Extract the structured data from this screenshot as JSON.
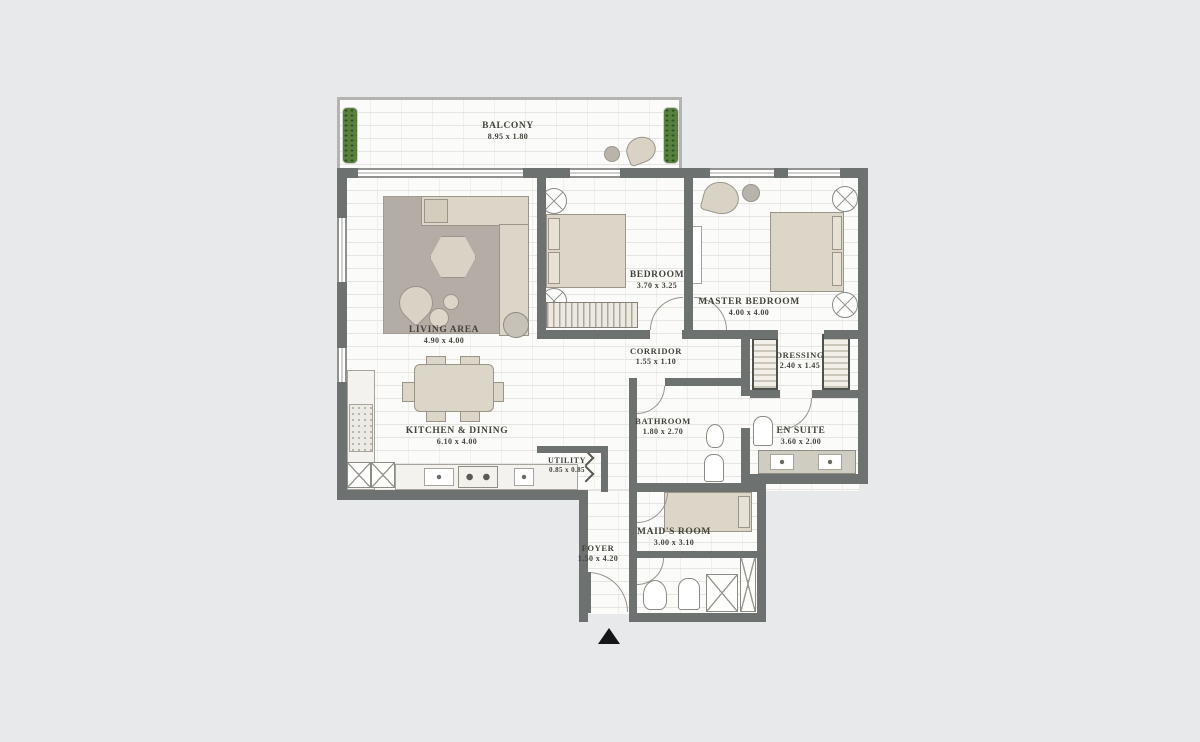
{
  "floor_plan": {
    "type": "apartment-floor-plan",
    "rooms": [
      {
        "id": "balcony",
        "name": "BALCONY",
        "dims": "8.95 x 1.80"
      },
      {
        "id": "living",
        "name": "LIVING AREA",
        "dims": "4.90 x 4.00"
      },
      {
        "id": "bedroom",
        "name": "BEDROOM",
        "dims": "3.70 x 3.25"
      },
      {
        "id": "master",
        "name": "MASTER BEDROOM",
        "dims": "4.00 x 4.00"
      },
      {
        "id": "corridor",
        "name": "CORRIDOR",
        "dims": "1.55 x 1.10"
      },
      {
        "id": "dressing",
        "name": "DRESSING",
        "dims": "2.40 x 1.45"
      },
      {
        "id": "bathroom",
        "name": "BATHROOM",
        "dims": "1.80 x 2.70"
      },
      {
        "id": "ensuite",
        "name": "EN SUITE",
        "dims": "3.60 x 2.00"
      },
      {
        "id": "kitchen",
        "name": "KITCHEN & DINING",
        "dims": "6.10 x 4.00"
      },
      {
        "id": "utility",
        "name": "UTILITY",
        "dims": "0.85 x 0.85"
      },
      {
        "id": "foyer",
        "name": "FOYER",
        "dims": "1.50 x 4.20"
      },
      {
        "id": "maids",
        "name": "MAID'S ROOM",
        "dims": "3.00 x 3.10"
      }
    ],
    "colors": {
      "background": "#e8e9eb",
      "wall": "#6d716f",
      "furniture": "#dbd6c8",
      "rug": "#b3ada5",
      "plant": "#598040",
      "label": "#44443d"
    }
  }
}
